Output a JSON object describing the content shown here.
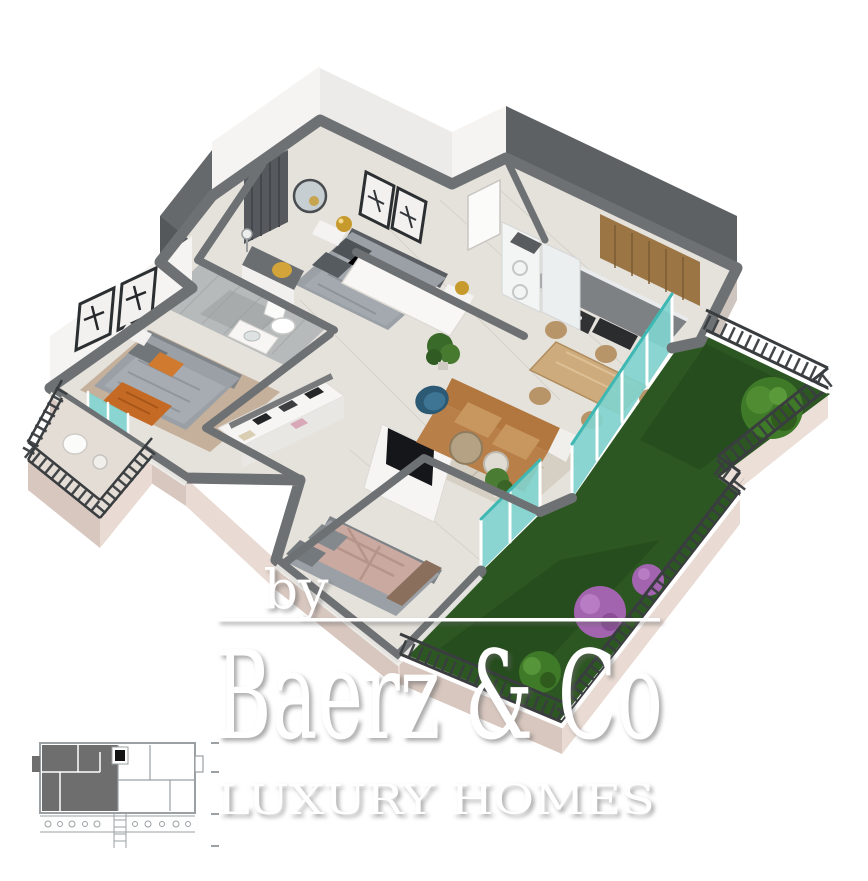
{
  "watermark": {
    "by_label": "by",
    "brand_name": "Baerz & Co",
    "tagline": "LUXURY HOMES"
  },
  "colors": {
    "background": "#ffffff",
    "wall_top": "#6e7173",
    "wall_dark": "#5d6164",
    "wall_white": "#f5f4f2",
    "floor": "#e5e2dc",
    "floor_tile": "#b7baba",
    "facade": "#e9dbd3",
    "facade_shadow": "#d8c7bf",
    "grass": "#2d5722",
    "grass_dark": "#1f4418",
    "glass_teal": "#7fd4cf",
    "teal_frame": "#3fb7b2",
    "railing": "#3a3d40",
    "sofa": "#b1773f",
    "sofa_light": "#c8965f",
    "rug_living": "#d6cfc3",
    "rug_bedroom": "#c5b09b",
    "bed": "#9aa0a5",
    "bed_blush": "#c9a9a0",
    "wood": "#9c7544",
    "table_wood": "#cdab7c",
    "accent_gold": "#c79a2e",
    "accent_blue": "#2c5a74",
    "accent_orange": "#c56a25",
    "bush_green": "#3f7a28",
    "bush_purple": "#a264ae",
    "watermark": "#ffffff",
    "inset_fill": "#6e6e6f",
    "inset_line": "#9aa0a3"
  }
}
